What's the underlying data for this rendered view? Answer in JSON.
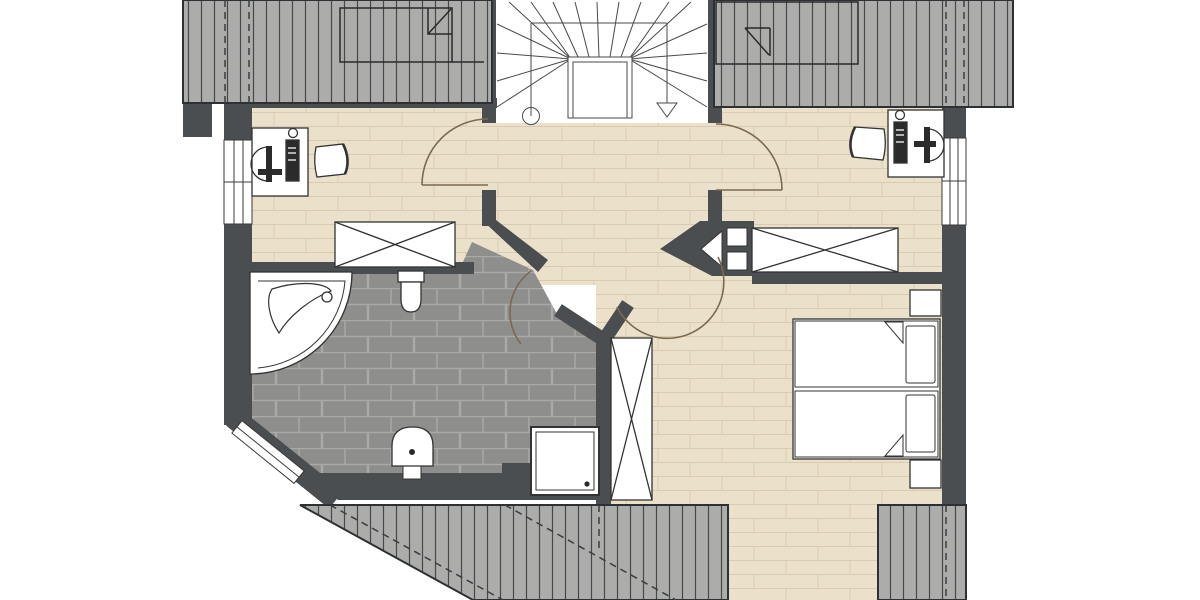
{
  "document": {
    "type": "architectural-floor-plan",
    "floor": "upper-storey",
    "visible_text_labels": [],
    "notes": "Pure graphic plan drawing; contains no rendered text, numbers or dimension labels"
  },
  "colors": {
    "background": "#FFFFFF",
    "wall": "#4A4E51",
    "roof_base": "#ACACAA",
    "roof_hatch_line": "#45484A",
    "roof_edge": "#2E3133",
    "roof_hidden_dash": "#3A3D3F",
    "wood_floor": "#EBE1CB",
    "wood_joint": "#D9CBAF",
    "tile_floor": "#8E8E8C",
    "tile_grout": "#A9A9A7",
    "stair_line": "#4A4A4A",
    "fixture_outline": "#333333",
    "fixture_dark": "#2B2B2B",
    "door_arc": "#7A6A50",
    "window_frame": "#3A3A3A",
    "fixture_fill": "#FFFFFF"
  },
  "rooms": [
    {
      "id": "top-left-room",
      "floor_finish": "wood-plank",
      "fixtures": [
        "desk",
        "computer-monitor",
        "pc-tower",
        "office-chair",
        "wardrobe"
      ],
      "openings": [
        "window-left-wall",
        "door-to-landing"
      ]
    },
    {
      "id": "stairwell",
      "floor_finish": "none",
      "fixtures": [
        "winder-staircase"
      ],
      "symbols": [
        "handrail-post-circle",
        "stair-direction-arrow"
      ]
    },
    {
      "id": "top-right-room",
      "floor_finish": "wood-plank",
      "fixtures": [
        "desk",
        "computer-monitor",
        "pc-tower",
        "office-chair",
        "wardrobe"
      ],
      "openings": [
        "window-right-wall",
        "door-to-landing"
      ]
    },
    {
      "id": "landing-hallway",
      "floor_finish": "wood-plank",
      "fixtures": [],
      "openings": [
        "door-to-bathroom",
        "door-to-bedroom"
      ]
    },
    {
      "id": "bathroom",
      "floor_finish": "tile-brick",
      "fixtures": [
        "corner-bathtub",
        "toilet",
        "washbasin",
        "shower"
      ],
      "openings": [
        "corner-window-chamfer",
        "door-to-landing"
      ]
    },
    {
      "id": "bedroom",
      "floor_finish": "wood-plank",
      "fixtures": [
        "double-bed",
        "nightstand-top",
        "nightstand-bottom",
        "tall-wardrobe",
        "chimney-block"
      ],
      "openings": [
        "door-to-landing"
      ]
    }
  ],
  "symbols": [
    "door-swing-arc-left-room",
    "door-swing-arc-right-room",
    "door-swing-arc-bathroom",
    "door-swing-arc-bedroom",
    "roof-hatching-top-left",
    "roof-hatching-top-right",
    "roof-hatching-bottom",
    "roof-hatching-bottom-right",
    "skylight-outline-top-left",
    "skylight-outline-top-right",
    "hidden-edge-dashed-lines"
  ]
}
